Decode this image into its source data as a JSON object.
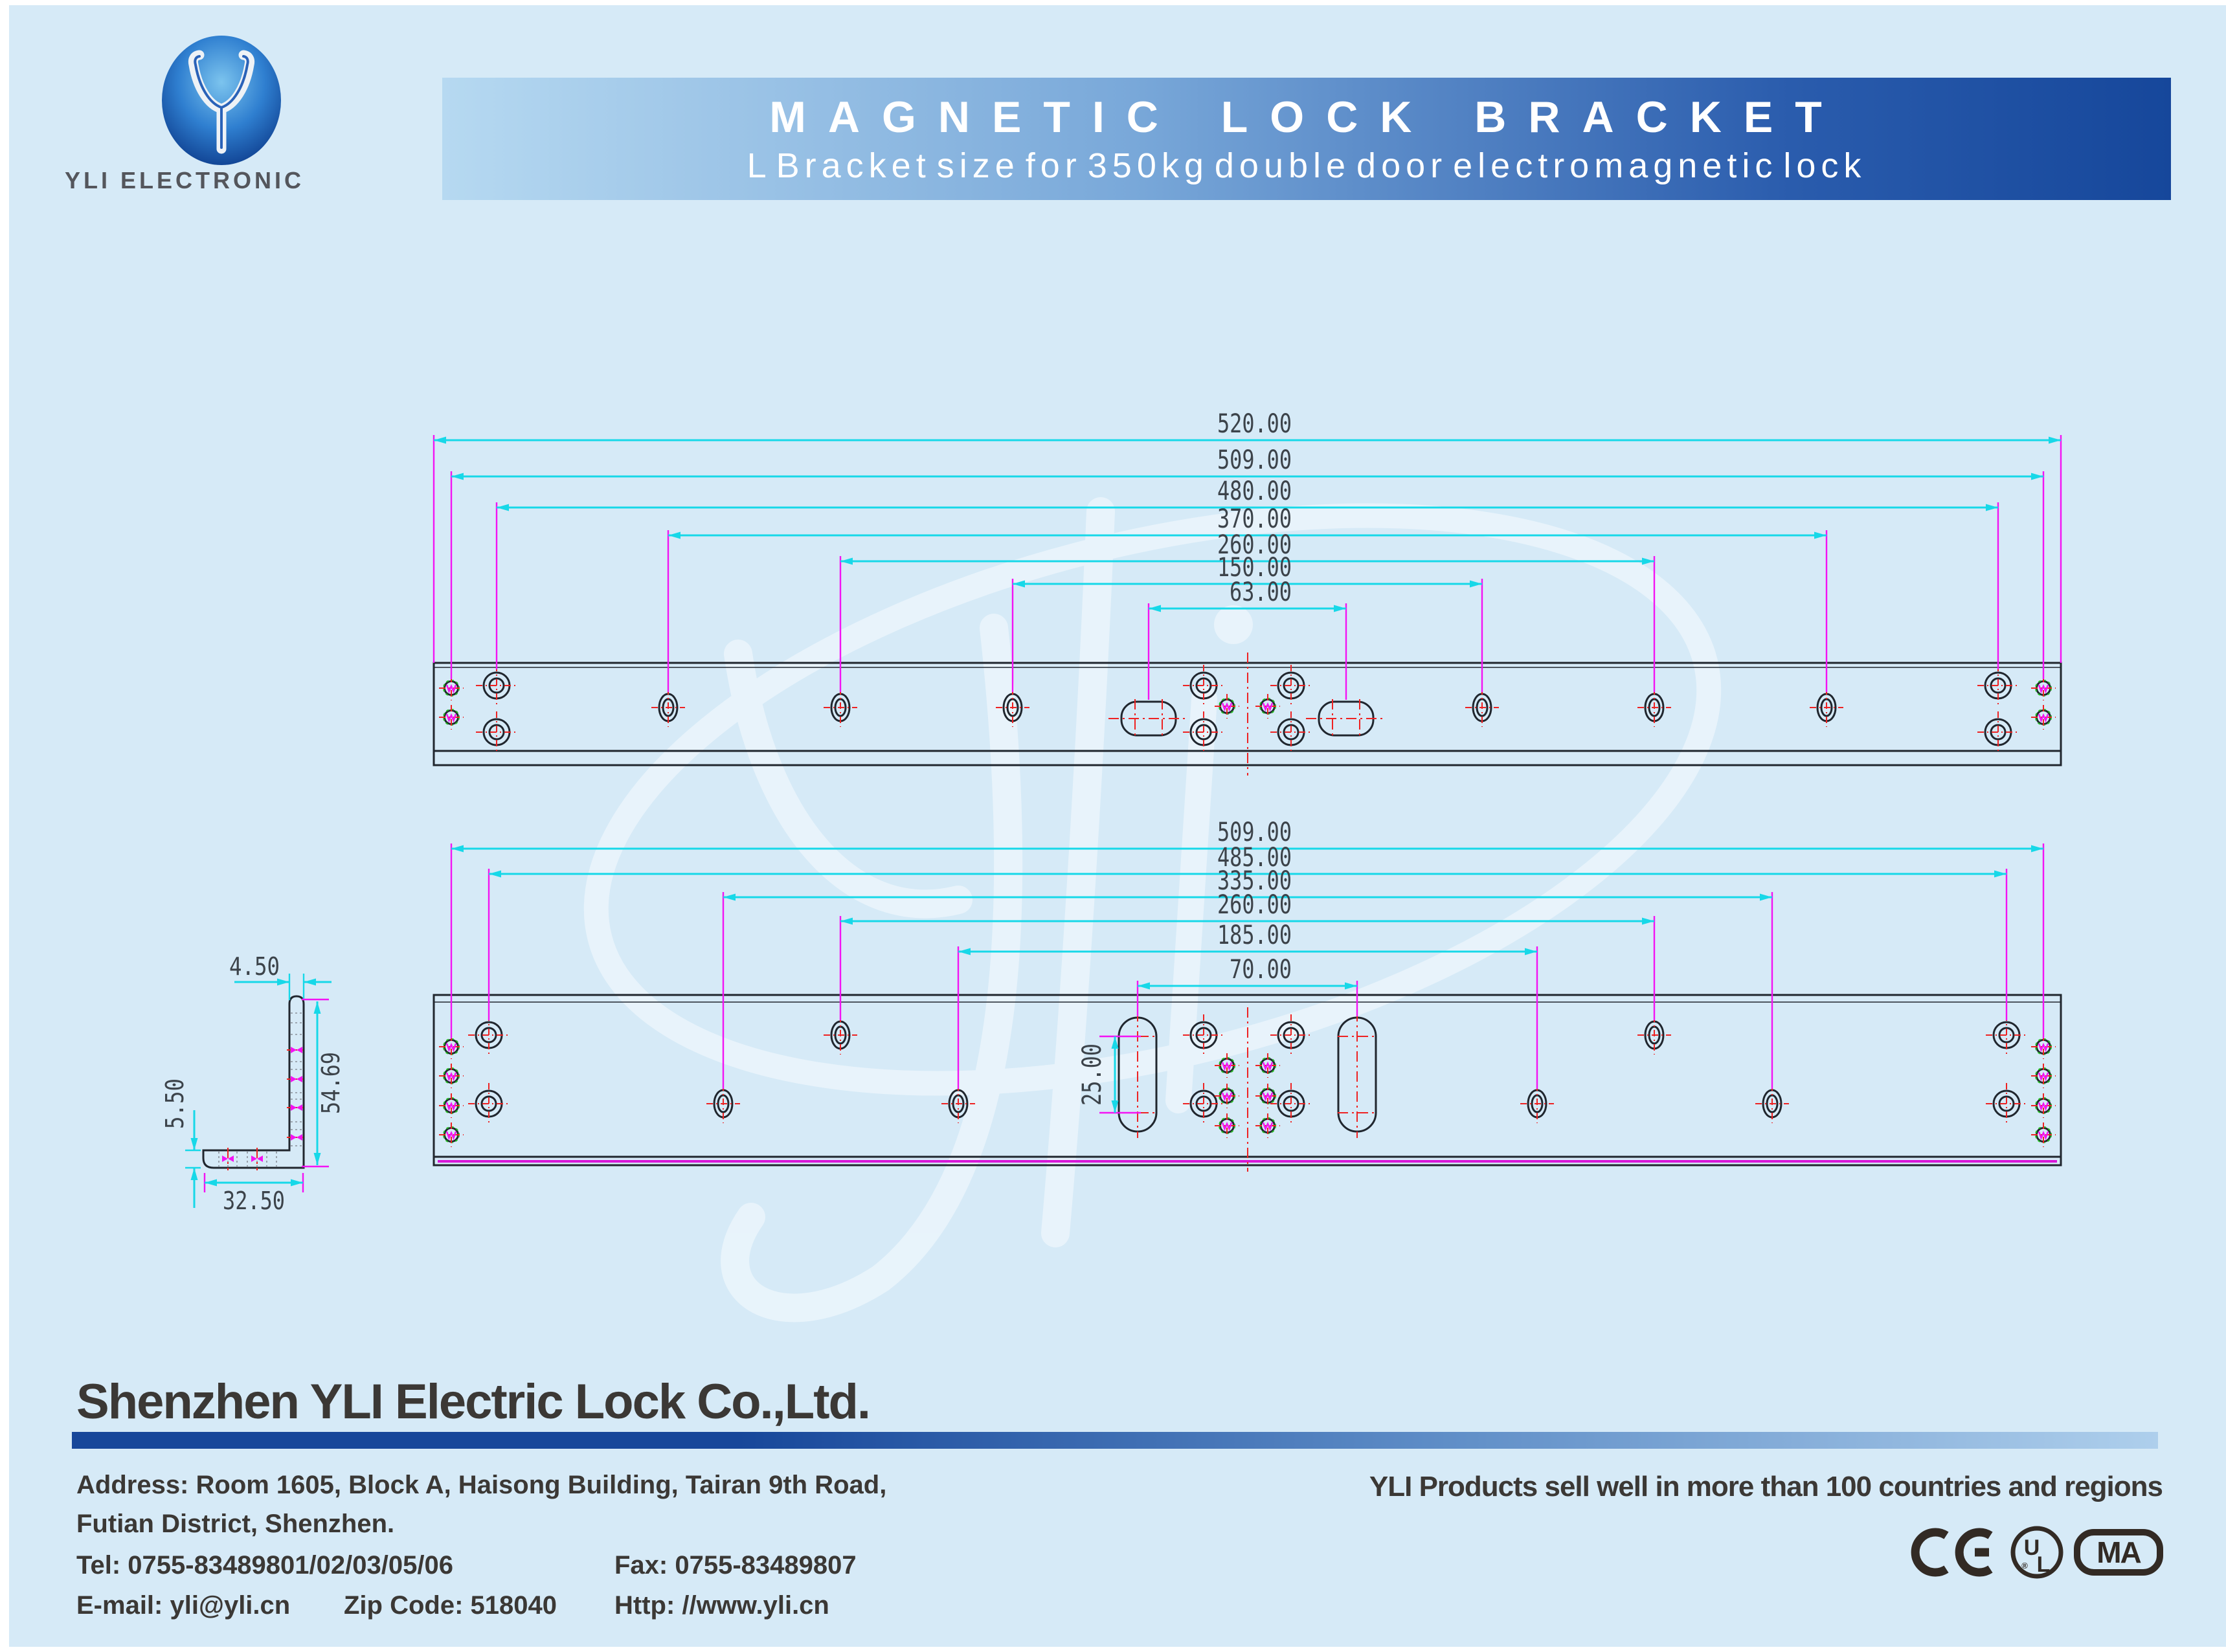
{
  "header": {
    "brand": "YLI ELECTRONIC",
    "title": "MAGNETIC LOCK BRACKET",
    "subtitle": "L Bracket size for 350kg double door electromagnetic lock"
  },
  "drawing": {
    "top_view": {
      "dims": [
        "520.00",
        "509.00",
        "480.00",
        "370.00",
        "260.00",
        "150.00",
        "63.00"
      ]
    },
    "bottom_view": {
      "dims": [
        "509.00",
        "485.00",
        "335.00",
        "260.00",
        "185.00",
        "70.00"
      ],
      "slot_dim": "25.00"
    },
    "side_view": {
      "top_thickness": "4.50",
      "leg_height": "54.69",
      "bottom_thickness": "5.50",
      "leg_width": "32.50"
    }
  },
  "footer": {
    "company": "Shenzhen YLI Electric Lock Co.,Ltd.",
    "address_line1": "Address: Room 1605, Block A, Haisong Building, Tairan 9th Road,",
    "address_line2": "Futian District, Shenzhen.",
    "tel": "Tel: 0755-83489801/02/03/05/06",
    "fax": "Fax: 0755-83489807",
    "email": "E-mail: yli@yli.cn",
    "zip": "Zip Code: 518040",
    "web": "Http: //www.yli.cn",
    "slogan": "YLI Products sell well in more than 100 countries and regions",
    "certs": {
      "ul_top": "U",
      "ul_bottom": "L",
      "reg": "®",
      "ma": "MA"
    }
  }
}
